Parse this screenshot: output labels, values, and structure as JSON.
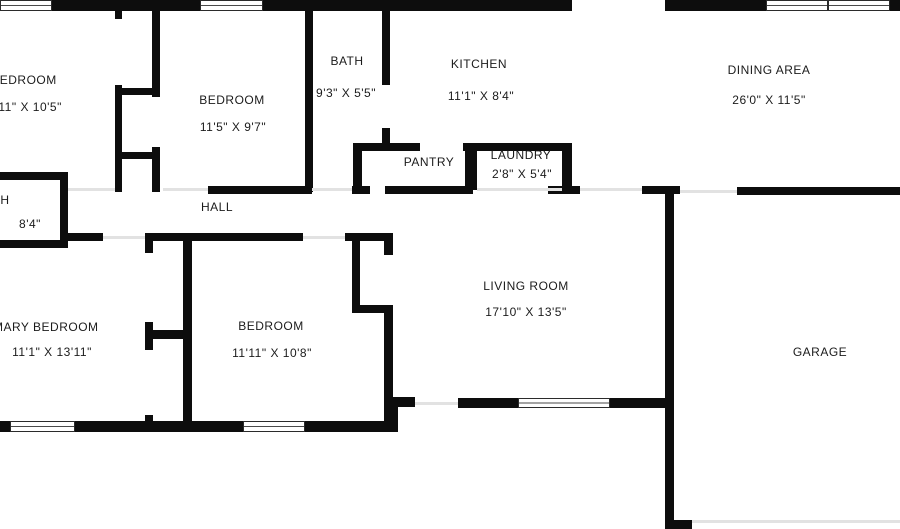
{
  "canvas": {
    "width": 900,
    "height": 529,
    "background_color": "#ffffff",
    "wall_color": "#0d0d0d",
    "threshold_color": "#e2e2e2",
    "text_color": "#1b1b1b"
  },
  "rooms": [
    {
      "id": "bedroom-top-left",
      "label": "BEDROOM",
      "dims": "11'11\" X 10'5\"",
      "label_cx": 24,
      "label_cy": 80,
      "dims_cx": 22,
      "dims_cy": 107
    },
    {
      "id": "bedroom-top-middle",
      "label": "BEDROOM",
      "dims": "11'5\" X 9'7\"",
      "label_cx": 232,
      "label_cy": 100,
      "dims_cx": 233,
      "dims_cy": 127
    },
    {
      "id": "bath-top",
      "label": "BATH",
      "dims": "9'3\" X 5'5\"",
      "label_cx": 347,
      "label_cy": 61,
      "dims_cx": 346,
      "dims_cy": 93
    },
    {
      "id": "kitchen",
      "label": "KITCHEN",
      "dims": "11'1\" X 8'4\"",
      "label_cx": 479,
      "label_cy": 64,
      "dims_cx": 481,
      "dims_cy": 96
    },
    {
      "id": "pantry",
      "label": "PANTRY",
      "dims": null,
      "label_cx": 429,
      "label_cy": 162,
      "dims_cx": null,
      "dims_cy": null
    },
    {
      "id": "laundry",
      "label": "LAUNDRY",
      "dims": "2'8\" X 5'4\"",
      "label_cx": 521,
      "label_cy": 155,
      "dims_cx": 522,
      "dims_cy": 174
    },
    {
      "id": "dining-area",
      "label": "DINING AREA",
      "dims": "26'0\" X 11'5\"",
      "label_cx": 769,
      "label_cy": 70,
      "dims_cx": 769,
      "dims_cy": 100
    },
    {
      "id": "bath-left",
      "label": "BATH",
      "dims": "8'4\"",
      "label_cx": -7,
      "label_cy": 200,
      "dims_cx": 30,
      "dims_cy": 224
    },
    {
      "id": "hall",
      "label": "HALL",
      "dims": null,
      "label_cx": 217,
      "label_cy": 207,
      "dims_cx": null,
      "dims_cy": null
    },
    {
      "id": "primary-bedroom",
      "label": "PRIMARY BEDROOM",
      "dims": "11'1\" X 13'11\"",
      "label_cx": 35,
      "label_cy": 327,
      "dims_cx": 52,
      "dims_cy": 352
    },
    {
      "id": "bedroom-bottom",
      "label": "BEDROOM",
      "dims": "11'11\" X 10'8\"",
      "label_cx": 271,
      "label_cy": 326,
      "dims_cx": 272,
      "dims_cy": 353
    },
    {
      "id": "living-room",
      "label": "LIVING ROOM",
      "dims": "17'10\" X 13'5\"",
      "label_cx": 526,
      "label_cy": 286,
      "dims_cx": 526,
      "dims_cy": 312
    },
    {
      "id": "garage",
      "label": "GARAGE",
      "dims": null,
      "label_cx": 820,
      "label_cy": 352,
      "dims_cx": null,
      "dims_cy": null
    }
  ],
  "floorplan": {
    "walls": [
      [
        52,
        0,
        148,
        11
      ],
      [
        263,
        0,
        309,
        11
      ],
      [
        665,
        0,
        101,
        11
      ],
      [
        890,
        0,
        10,
        11
      ],
      [
        115,
        11,
        7,
        8
      ],
      [
        115,
        85,
        7,
        107
      ],
      [
        152,
        11,
        8,
        86
      ],
      [
        152,
        147,
        8,
        45
      ],
      [
        115,
        88,
        45,
        7
      ],
      [
        115,
        152,
        45,
        7
      ],
      [
        305,
        11,
        8,
        181
      ],
      [
        382,
        11,
        8,
        74
      ],
      [
        382,
        128,
        8,
        23
      ],
      [
        353,
        143,
        9,
        49
      ],
      [
        353,
        143,
        67,
        8
      ],
      [
        463,
        143,
        109,
        8
      ],
      [
        465,
        151,
        12,
        39
      ],
      [
        562,
        151,
        10,
        39
      ],
      [
        208,
        186,
        104,
        8
      ],
      [
        352,
        186,
        18,
        8
      ],
      [
        385,
        186,
        88,
        8
      ],
      [
        548,
        186,
        32,
        8
      ],
      [
        642,
        186,
        38,
        8
      ],
      [
        737,
        187,
        163,
        8
      ],
      [
        0,
        172,
        68,
        8
      ],
      [
        60,
        180,
        8,
        68
      ],
      [
        0,
        240,
        68,
        8
      ],
      [
        68,
        233,
        35,
        8
      ],
      [
        145,
        233,
        158,
        8
      ],
      [
        345,
        233,
        48,
        8
      ],
      [
        145,
        241,
        8,
        12
      ],
      [
        145,
        322,
        8,
        28
      ],
      [
        145,
        415,
        8,
        17
      ],
      [
        183,
        241,
        9,
        191
      ],
      [
        145,
        330,
        38,
        9
      ],
      [
        352,
        241,
        8,
        64
      ],
      [
        352,
        305,
        41,
        8
      ],
      [
        384,
        241,
        9,
        14
      ],
      [
        384,
        305,
        9,
        123
      ],
      [
        393,
        397,
        22,
        10
      ],
      [
        458,
        398,
        60,
        10
      ],
      [
        610,
        398,
        63,
        10
      ],
      [
        390,
        398,
        8,
        34
      ],
      [
        0,
        421,
        10,
        11
      ],
      [
        75,
        421,
        168,
        11
      ],
      [
        305,
        421,
        90,
        11
      ],
      [
        665,
        190,
        9,
        338
      ],
      [
        665,
        520,
        27,
        9
      ]
    ],
    "windows": [
      [
        0,
        0,
        52,
        11
      ],
      [
        200,
        0,
        63,
        11
      ],
      [
        766,
        0,
        62,
        11
      ],
      [
        828,
        0,
        62,
        11
      ],
      [
        10,
        421,
        65,
        11
      ],
      [
        243,
        421,
        62,
        11
      ],
      [
        518,
        398,
        92,
        10
      ]
    ],
    "thresholds": [
      [
        68,
        188,
        47,
        3
      ],
      [
        163,
        188,
        45,
        3
      ],
      [
        312,
        188,
        40,
        3
      ],
      [
        103,
        236,
        42,
        3
      ],
      [
        303,
        236,
        42,
        3
      ],
      [
        477,
        188,
        85,
        3
      ],
      [
        580,
        188,
        62,
        3
      ],
      [
        680,
        190,
        57,
        3
      ],
      [
        415,
        402,
        43,
        3
      ],
      [
        692,
        520,
        208,
        3
      ]
    ]
  }
}
